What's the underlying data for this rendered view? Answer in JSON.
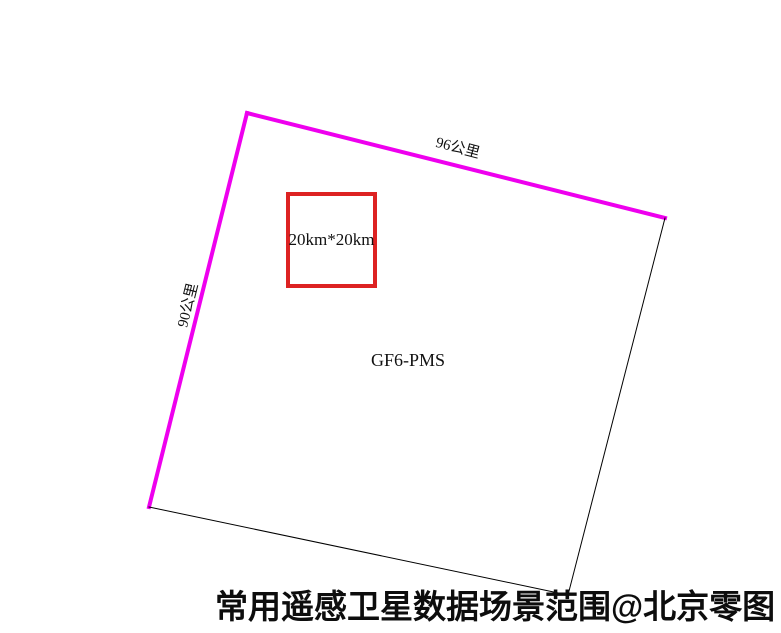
{
  "diagram": {
    "caption": "常用遥感卫星数据场景范围@北京零图",
    "scene": {
      "label": "GF6-PMS",
      "top_edge_label": "96公里",
      "left_edge_label": "90公里",
      "outline_color_highlighted": "#ee00ee",
      "outline_color_plain": "#000000",
      "outline_width_highlighted": 4,
      "outline_width_plain": 1,
      "corners": [
        [
          247,
          113
        ],
        [
          665,
          218
        ],
        [
          568,
          595
        ],
        [
          149,
          507
        ]
      ]
    },
    "subset_square": {
      "label": "20km*20km",
      "outline_color": "#dd2222",
      "outline_width": 4,
      "x": 286,
      "y": 192,
      "width": 91,
      "height": 96
    }
  }
}
